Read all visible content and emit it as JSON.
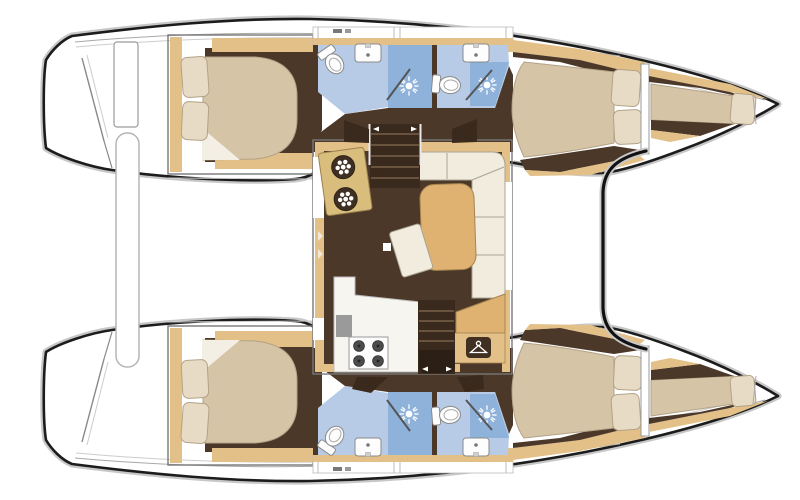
{
  "description": "Catamaran interior layout floor plan, top-down view, bows to the right",
  "palette": {
    "outline": "#1c1c1c",
    "halo": "#c7c7c7",
    "deckline": "#a8a8a8",
    "wood": "#e2c088",
    "woodEdge": "#a5854f",
    "gold": "#dfb271",
    "floor": "#4c3829",
    "floorDark": "#3a2a1d",
    "stepLine": "#79604a",
    "mattress": "#d6c4a6",
    "mattressEdge": "#b3a287",
    "pillow": "#e7dbc5",
    "linen": "#f2ecdf",
    "setteeEdge": "#a9a492",
    "tile": "#b7cbe6",
    "tileDark": "#8fb2da"
  },
  "legend": {
    "hulls": [
      "top-hull",
      "bottom-hull"
    ],
    "rooms_per_hull": [
      "aft-cabin",
      "aft-head",
      "forward-head",
      "forward-cabin",
      "forepeak-berth"
    ],
    "salon_features": [
      "galley-sink-unit",
      "port-companionway-stairs",
      "starboard-companionway-stairs",
      "l-shaped-settee",
      "dining-table",
      "movable-bench",
      "galley-counter",
      "four-burner-stove",
      "wardrobe-locker",
      "entry-step"
    ],
    "deck_features": [
      "transom-steps",
      "stern-crossbar",
      "helm-seat",
      "forward-crossbeam"
    ],
    "icons": [
      "shower-spray-icon",
      "toilet-icon",
      "sink-icon",
      "hanger-icon",
      "sink-drain-icon",
      "burner-icon"
    ]
  },
  "counts": {
    "double_cabins": 4,
    "heads": 4,
    "shower_stalls": 4,
    "toilets": 4,
    "sinks": 4,
    "forepeak_berths": 2,
    "salons": 1,
    "galleys": 1
  }
}
